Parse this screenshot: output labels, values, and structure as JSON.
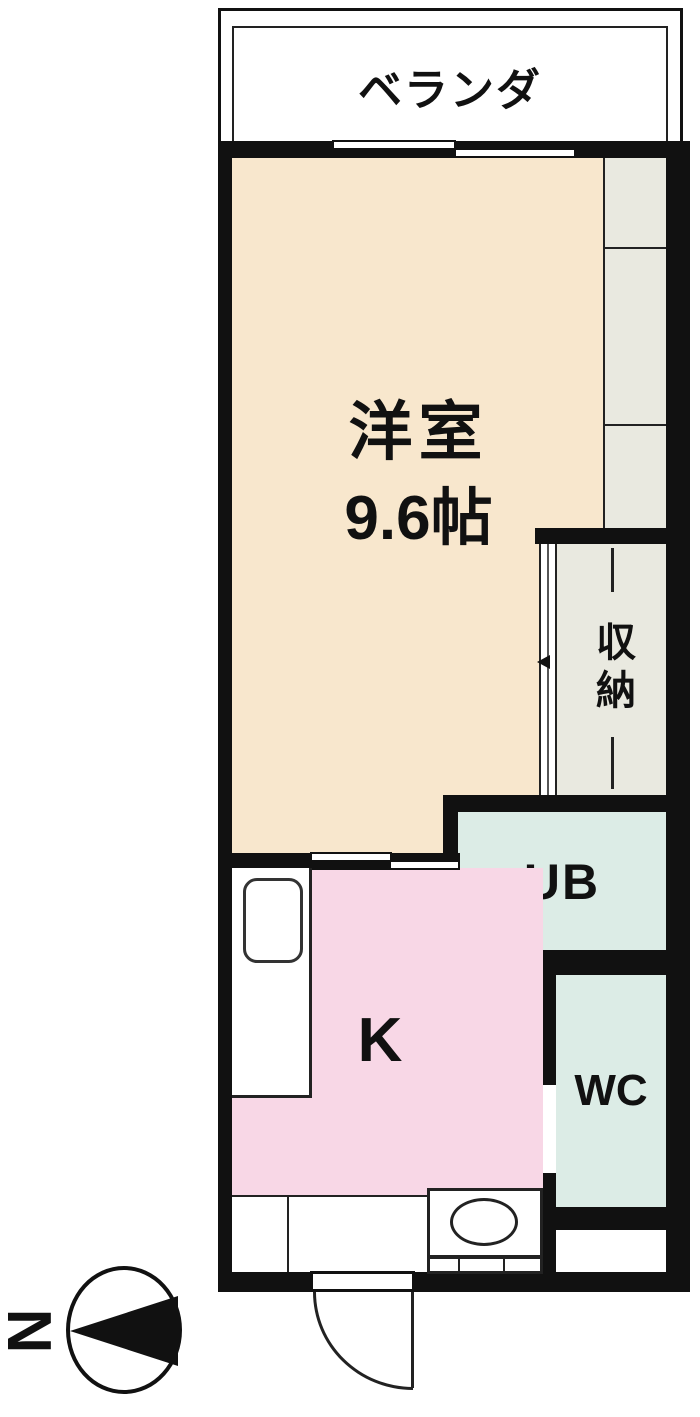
{
  "floorplan": {
    "rooms": {
      "balcony": {
        "label": "ベランダ"
      },
      "western_room": {
        "label": "洋室",
        "size": "9.6帖"
      },
      "storage": {
        "label": "収納"
      },
      "unit_bath": {
        "label": "UB"
      },
      "kitchen": {
        "label": "K"
      },
      "toilet": {
        "label": "WC"
      }
    },
    "compass": {
      "label": "N",
      "direction": "left"
    },
    "colors": {
      "wall": "#111111",
      "western_room_fill": "#f8e7cd",
      "kitchen_fill": "#f8d7e6",
      "bath_fill": "#dcece6",
      "storage_fill": "#e9e9e0",
      "background": "#ffffff"
    },
    "symbols": [
      "sliding-window",
      "sliding-door",
      "hinged-door-swing",
      "washing-machine-space",
      "kitchen-sink",
      "washbasin",
      "north-arrow"
    ]
  }
}
